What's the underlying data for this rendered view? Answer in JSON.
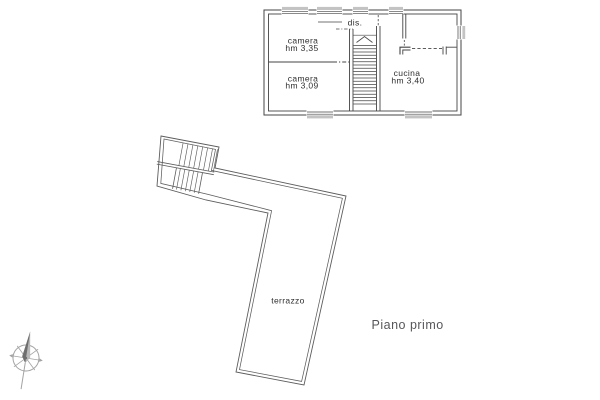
{
  "plan": {
    "caption": "Piano primo",
    "rooms": {
      "camera_1": {
        "name": "camera",
        "height": "hm 3,35"
      },
      "camera_2": {
        "name": "camera",
        "height": "hm 3,09"
      },
      "cucina": {
        "name": "cucina",
        "height": "hm 3,40"
      },
      "disimpegno": {
        "name": "dis."
      }
    },
    "terrace": {
      "name": "terrazzo"
    }
  },
  "colors": {
    "background": "#ffffff",
    "plan_line": "#454545",
    "terrace_line": "#5c5c5c",
    "window_sill": "#c3c3c3",
    "room_label": "#2e2e2e",
    "caption": "#57575b",
    "compass": "#a3a3a3",
    "compass_needle_dark": "#6e6e6e",
    "compass_needle_light": "#b8b8b8"
  }
}
